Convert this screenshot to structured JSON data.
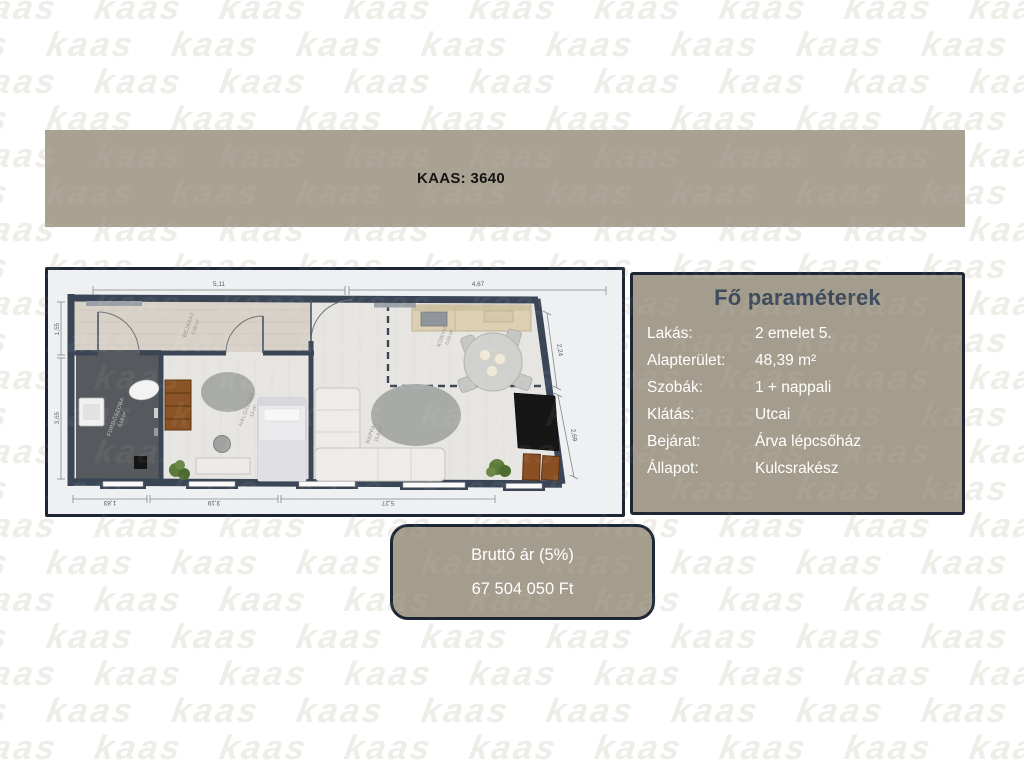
{
  "watermark": {
    "text": "kaas"
  },
  "header": {
    "title": "KAAS: 3640",
    "bg_color": "#a9a192"
  },
  "colors": {
    "taupe": "#a49c8c",
    "navy_border": "#1c2733",
    "title_navy": "#3d4b5c",
    "wall": "#3a4656"
  },
  "floorplan": {
    "dimensions": {
      "top": [
        "5,11",
        "4,67"
      ],
      "bottom": [
        "1,83",
        "3,19",
        "5,27"
      ],
      "left": [
        "1,55",
        "3,65"
      ],
      "right": [
        "2,24",
        "2,69"
      ]
    },
    "rooms": [
      {
        "name": "BEJÁRAT",
        "area": "6,08 m²"
      },
      {
        "name": "FÜRDŐSZOBA",
        "area": "6,58 m²"
      },
      {
        "name": "HÁLÓSZOBA",
        "area": "13 m²"
      },
      {
        "name": "KONYHA",
        "area": "6,06 m²"
      },
      {
        "name": "NAPPALI",
        "area": "16,8 m²"
      }
    ]
  },
  "parameters": {
    "title": "Fő paraméterek",
    "rows": [
      {
        "label": "Lakás:",
        "value": "2 emelet 5."
      },
      {
        "label": "Alapterület:",
        "value": "48,39 m²"
      },
      {
        "label": "Szobák:",
        "value": "1 + nappali"
      },
      {
        "label": "Klátás:",
        "value": "Utcai"
      },
      {
        "label": "Bejárat:",
        "value": "Árva lépcsőház"
      },
      {
        "label": "Állapot:",
        "value": "Kulcsrakész"
      }
    ]
  },
  "price": {
    "label": "Bruttó ár (5%)",
    "value": "67 504 050 Ft"
  }
}
